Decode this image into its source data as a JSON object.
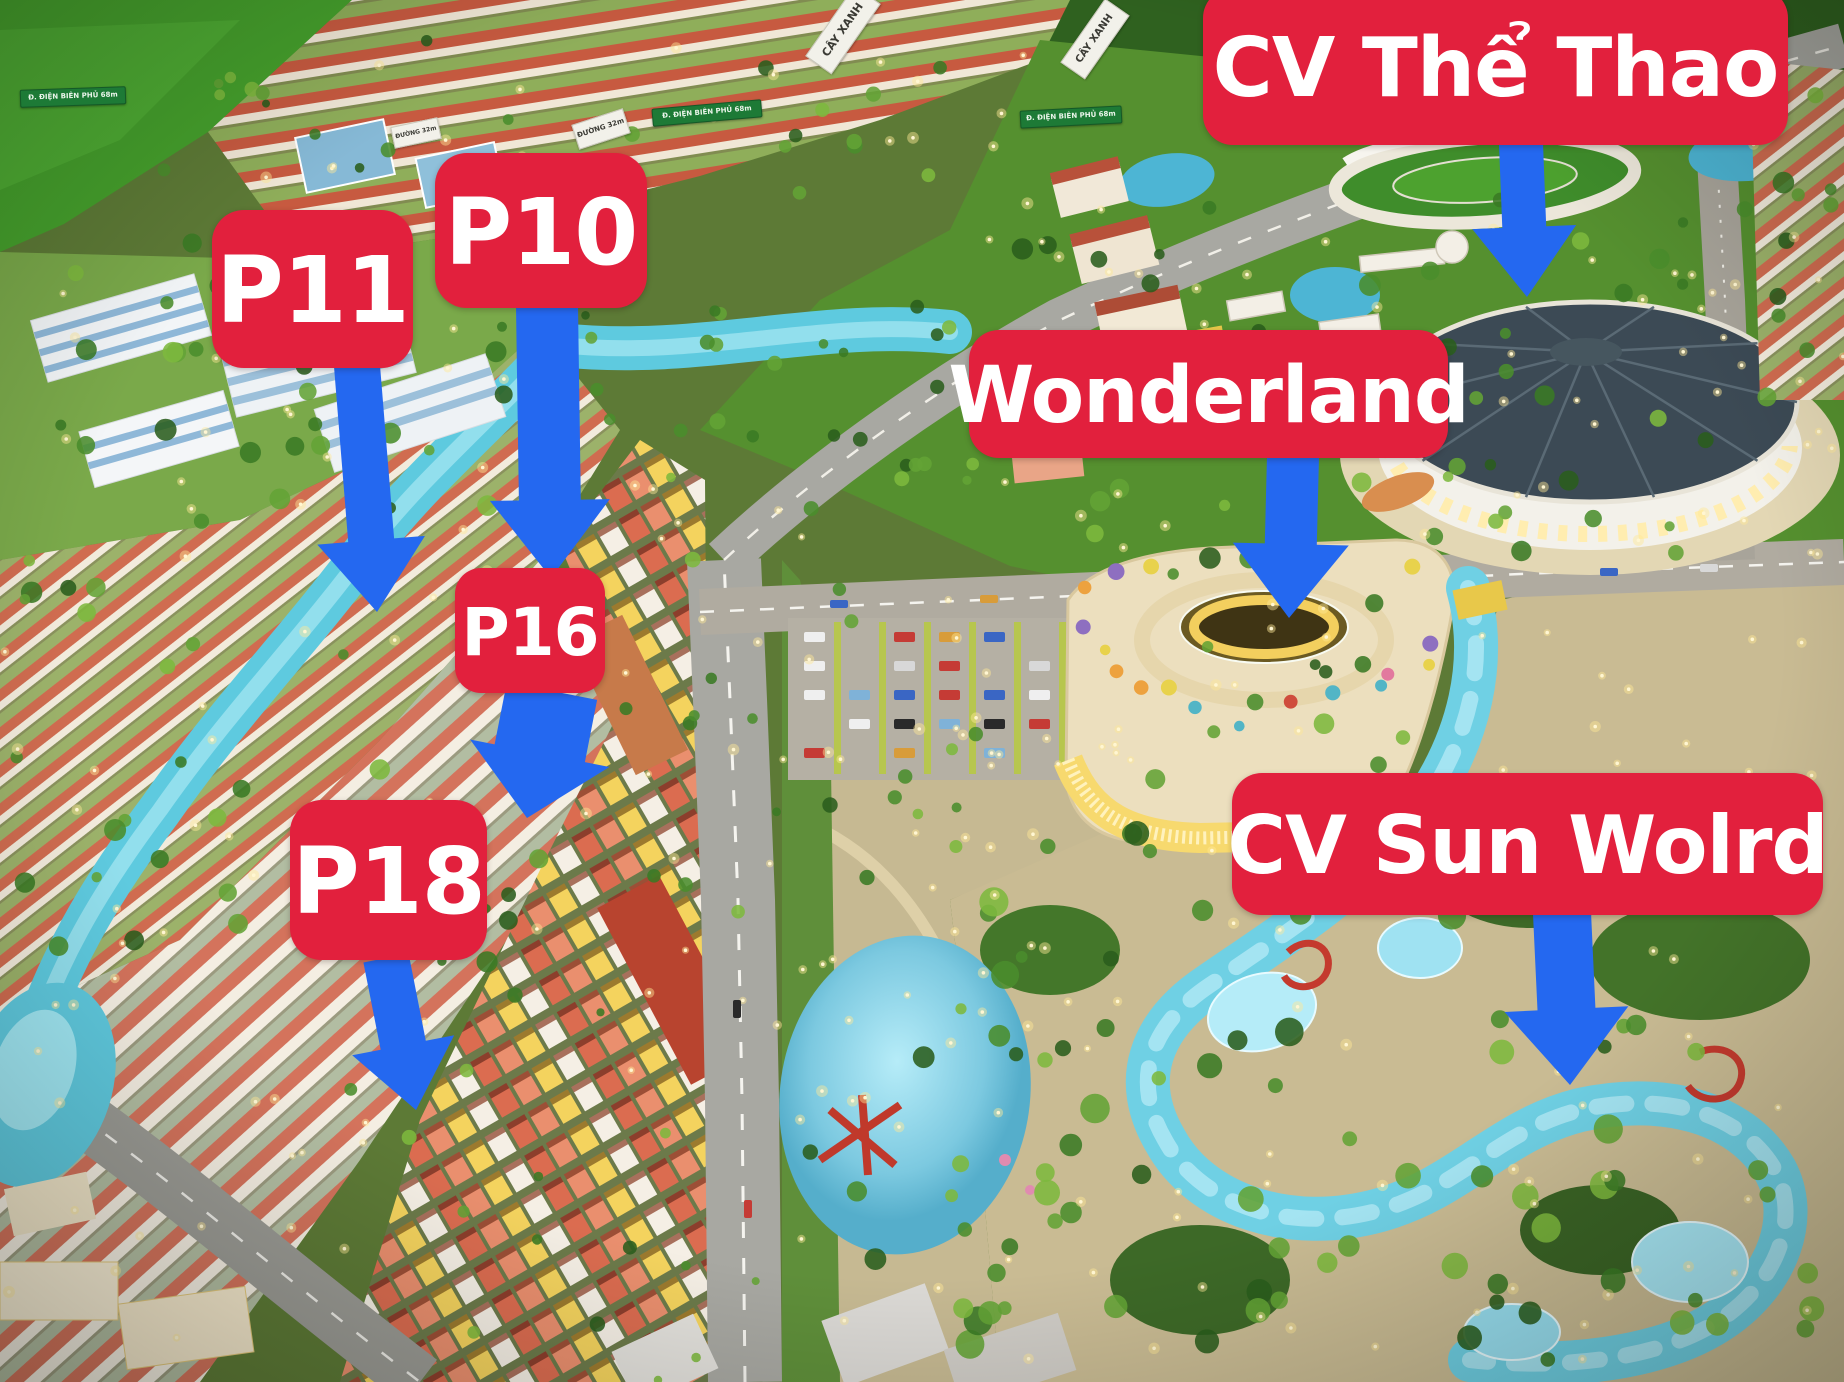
{
  "colors": {
    "label_bg": "#E2203D",
    "label_text": "#FFFFFF",
    "arrow_blue": "#2468F0",
    "water": "#5FC9DE",
    "grass": "#4C8F2E",
    "sand": "#CDBF98",
    "roof_red": "#C75A40"
  },
  "annotations": [
    {
      "id": "p11",
      "label": "P11",
      "box": {
        "x": 212,
        "y": 210,
        "w": 201,
        "h": 158,
        "r": 32
      },
      "font": 92,
      "arrow": {
        "x1": 357,
        "y1": 366,
        "x2": 377,
        "y2": 612,
        "shaft": 46,
        "head_w": 108,
        "head_l": 72
      }
    },
    {
      "id": "p10",
      "label": "P10",
      "box": {
        "x": 435,
        "y": 153,
        "w": 212,
        "h": 155,
        "r": 32
      },
      "font": 92,
      "arrow": {
        "x1": 547,
        "y1": 306,
        "x2": 551,
        "y2": 578,
        "shaft": 62,
        "head_w": 120,
        "head_l": 78
      }
    },
    {
      "id": "p16",
      "label": "P16",
      "box": {
        "x": 455,
        "y": 568,
        "w": 150,
        "h": 125,
        "r": 26
      },
      "font": 66,
      "arrow": {
        "x1": 552,
        "y1": 691,
        "x2": 527,
        "y2": 818,
        "shaft": 92,
        "head_w": 142,
        "head_l": 66
      }
    },
    {
      "id": "p18",
      "label": "P18",
      "box": {
        "x": 290,
        "y": 800,
        "w": 197,
        "h": 160,
        "r": 32
      },
      "font": 92,
      "arrow": {
        "x1": 386,
        "y1": 958,
        "x2": 416,
        "y2": 1110,
        "shaft": 46,
        "head_w": 104,
        "head_l": 66
      }
    },
    {
      "id": "wonderland",
      "label": "Wonderland",
      "box": {
        "x": 969,
        "y": 330,
        "w": 479,
        "h": 128,
        "r": 30
      },
      "font": 78,
      "arrow": {
        "x1": 1293,
        "y1": 456,
        "x2": 1289,
        "y2": 618,
        "shaft": 52,
        "head_w": 116,
        "head_l": 74
      }
    },
    {
      "id": "cv-the-thao",
      "label": "CV Thể Thao",
      "box": {
        "x": 1203,
        "y": -12,
        "w": 585,
        "h": 157,
        "r": 30
      },
      "font": 82,
      "arrow": {
        "x1": 1521,
        "y1": 144,
        "x2": 1527,
        "y2": 297,
        "shaft": 44,
        "head_w": 104,
        "head_l": 70
      }
    },
    {
      "id": "cv-sun-wolrd",
      "label": "CV Sun Wolrd",
      "box": {
        "x": 1232,
        "y": 773,
        "w": 591,
        "h": 142,
        "r": 30
      },
      "font": 80,
      "arrow": {
        "x1": 1562,
        "y1": 913,
        "x2": 1570,
        "y2": 1085,
        "shaft": 58,
        "head_w": 124,
        "head_l": 76
      }
    }
  ],
  "signs": [
    {
      "text": "CÂY XANH",
      "style": "white",
      "x": 800,
      "y": 14,
      "w": 84,
      "h": 30,
      "rot": -55,
      "fs": 11
    },
    {
      "text": "CÂY XANH",
      "style": "white",
      "x": 1056,
      "y": 24,
      "w": 76,
      "h": 28,
      "rot": -55,
      "fs": 10
    },
    {
      "text": "Đ. ĐIỆN BIÊN PHỦ 68m",
      "style": "green",
      "x": 20,
      "y": 88,
      "w": 104,
      "h": 16,
      "rot": -2,
      "fs": 7
    },
    {
      "text": "Đ. ĐIỆN BIÊN PHỦ 68m",
      "style": "green",
      "x": 652,
      "y": 104,
      "w": 108,
      "h": 16,
      "rot": -5,
      "fs": 7
    },
    {
      "text": "Đ. ĐIỆN BIÊN PHỦ 68m",
      "style": "green",
      "x": 1020,
      "y": 108,
      "w": 100,
      "h": 16,
      "rot": -3,
      "fs": 7
    },
    {
      "text": "ĐƯỜNG 32m",
      "style": "white",
      "x": 574,
      "y": 116,
      "w": 52,
      "h": 24,
      "rot": -18,
      "fs": 7
    },
    {
      "text": "ĐƯỜNG 32m",
      "style": "white",
      "x": 392,
      "y": 122,
      "w": 46,
      "h": 20,
      "rot": -12,
      "fs": 6
    }
  ]
}
